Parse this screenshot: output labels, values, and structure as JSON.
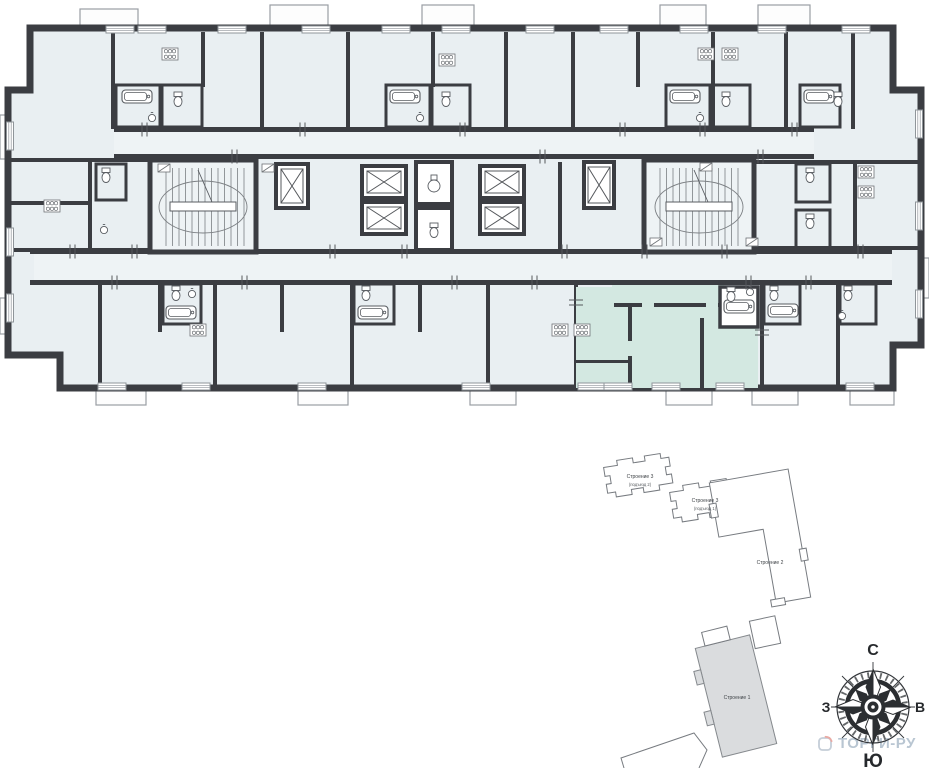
{
  "floor_plan": {
    "description": "residential floor plan",
    "colors": {
      "wall": "#3b3d42",
      "room": "#e9eff2",
      "corridor": "#eef3f5",
      "highlight": "#d3e8e1",
      "window": "#8f959a",
      "fixture_line": "#595d62"
    }
  },
  "site_plan": {
    "outline_color": "#777b80",
    "highlight_fill": "#dadcde",
    "buildings": [
      {
        "label": "Строение 3",
        "sublabel": "(подъезд 2)",
        "highlighted": false
      },
      {
        "label": "Строение 3",
        "sublabel": "(подъезд 1)",
        "highlighted": false
      },
      {
        "label": "Строение 2",
        "sublabel": "",
        "highlighted": false
      },
      {
        "label": "Строение 1",
        "sublabel": "",
        "highlighted": true
      }
    ]
  },
  "compass": {
    "north": "С",
    "south": "Ю",
    "west": "З",
    "east": "В"
  },
  "logo": {
    "text": "ТОРГИ-РУ",
    "text_color": "#b9c6d2",
    "roof_color": "#e9aaa4"
  }
}
